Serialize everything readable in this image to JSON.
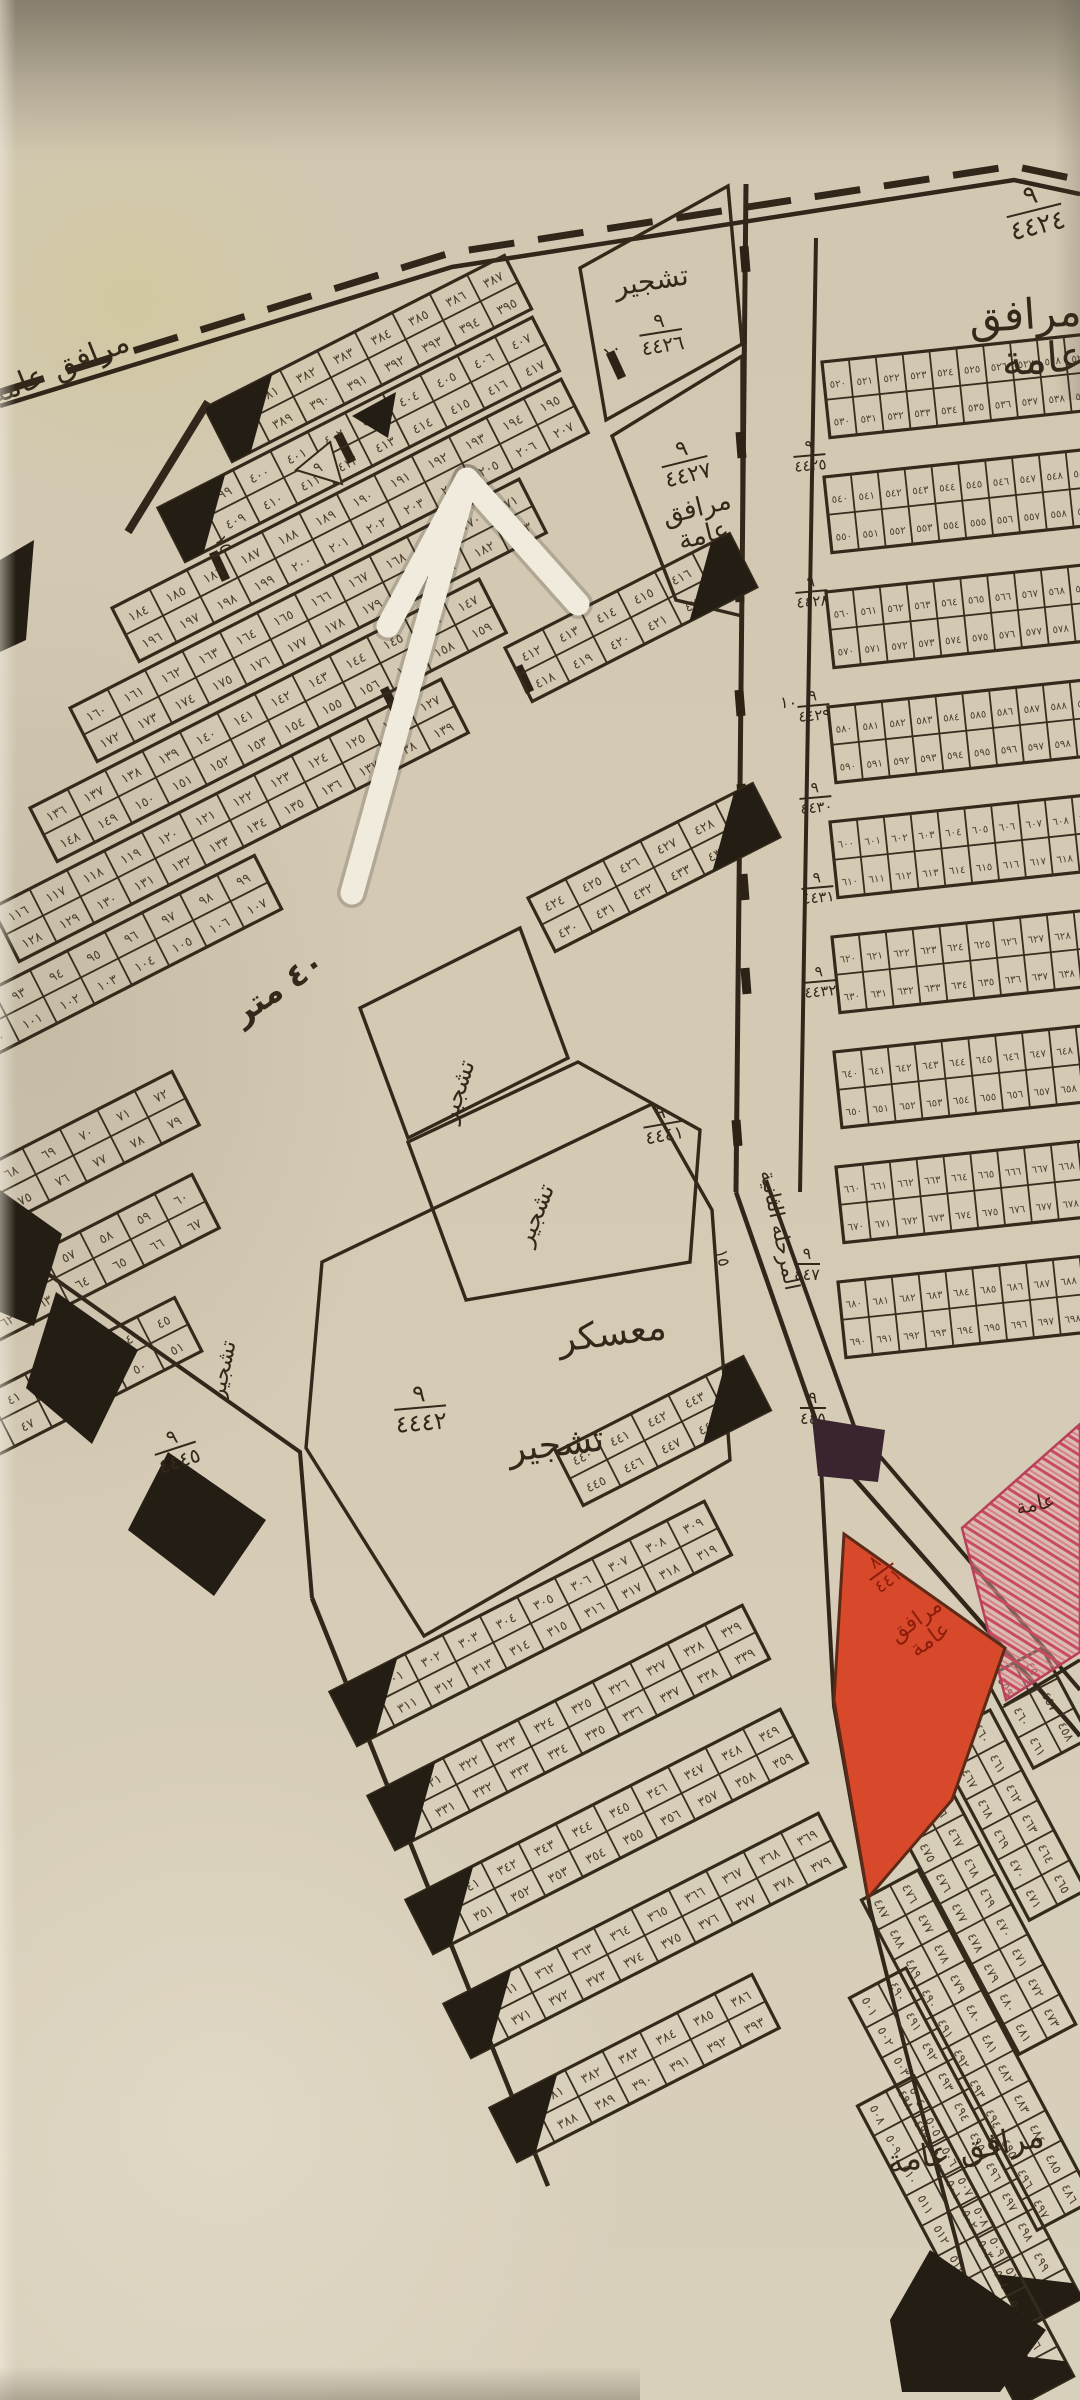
{
  "document": {
    "type": "hand-drawn cadastral subdivision map photograph"
  },
  "colors": {
    "paper": "#d5cbb5",
    "ink": "#33291b",
    "black_fill": "#241d14",
    "red_zone": "#d8492b",
    "pink_hatch": "#c94b63",
    "red_text": "#8c1d0c",
    "arrow": "#f1ebdd"
  },
  "labels": {
    "facilities_top_right": "مرافق عامة",
    "facilities_left": "مرافق عامة",
    "facilities_mid": "مرافق\nعامة",
    "tashjir_top": "تشجير",
    "tashjir_a": "تشجير",
    "tashjir_b": "تشجير",
    "tashjir_left": "تشجير",
    "camp": "معسكر",
    "camp_tashjir": "تشجير",
    "road_forty": "٤٠ متر",
    "road_name_vertical": "المرحلة الثانية",
    "red_facilities": "مرافق\nعامة",
    "pink_amma": "عامة",
    "facilities_bottom": "مرافق عامة",
    "width_15_a": "١٥",
    "width_15_b": "١٥",
    "width_10_a": "١٠",
    "width_10_b": "١٠",
    "small_nine": "٩"
  },
  "fractions": {
    "top_right": {
      "num": "٩",
      "den": "٤٤٢٤"
    },
    "tashjir_top": {
      "num": "٩",
      "den": "٤٤٢٦"
    },
    "mid": {
      "num": "٩",
      "den": "٤٤٢٧"
    },
    "tashjir_b": {
      "num": "٩",
      "den": "٤٤٤١"
    },
    "camp": {
      "num": "٩",
      "den": "٤٤٤٢"
    },
    "left_block": {
      "num": "٩",
      "den": "٤٤٤٥"
    },
    "road_a": {
      "num": "٩",
      "den": "٤٤٧"
    },
    "road_b": {
      "num": "٩",
      "den": "٤٤٥"
    },
    "red": {
      "num": "٨",
      "den": "٤٤١"
    }
  },
  "road_block_ids": [
    {
      "num": "٩",
      "den": "٤٤٢٥",
      "x": 792,
      "y": 440
    },
    {
      "num": "٩",
      "den": "٤٤٢٨",
      "x": 794,
      "y": 576
    },
    {
      "num": "٩",
      "den": "٤٤٢٩",
      "x": 796,
      "y": 690
    },
    {
      "num": "٩",
      "den": "٤٤٣٠",
      "x": 798,
      "y": 782
    },
    {
      "num": "٩",
      "den": "٤٤٣١",
      "x": 800,
      "y": 872
    },
    {
      "num": "٩",
      "den": "٤٤٣٢",
      "x": 802,
      "y": 966
    }
  ],
  "map": {
    "digits": "٠١٢٣٤٥٦٧٨٩",
    "blocks": [
      {
        "x": 205,
        "y": 408,
        "len": 336,
        "a": -27,
        "start": 380,
        "w": "left"
      },
      {
        "x": 158,
        "y": 508,
        "len": 430,
        "a": -27,
        "start": 398,
        "w": "left"
      },
      {
        "x": 112,
        "y": 608,
        "len": 500,
        "a": -27,
        "start": 184
      },
      {
        "x": 70,
        "y": 708,
        "len": 515,
        "a": -27,
        "start": 160
      },
      {
        "x": 30,
        "y": 808,
        "len": 515,
        "a": -27,
        "start": 136
      },
      {
        "x": -8,
        "y": 908,
        "len": 495,
        "a": -27,
        "start": 116
      },
      {
        "x": -45,
        "y": 1008,
        "len": 330,
        "a": -27,
        "start": 92
      },
      {
        "x": -90,
        "y": 1205,
        "len": 300,
        "a": -27,
        "start": 66
      },
      {
        "x": -70,
        "y": 1308,
        "len": 285,
        "a": -27,
        "start": 54
      },
      {
        "x": -50,
        "y": 1412,
        "len": 260,
        "a": -27,
        "start": 40
      },
      {
        "x": 505,
        "y": 648,
        "len": 240,
        "a": -27,
        "start": 412,
        "w": "right"
      },
      {
        "x": 528,
        "y": 898,
        "len": 245,
        "a": -27,
        "start": 424,
        "w": "right"
      },
      {
        "x": 556,
        "y": 1452,
        "len": 225,
        "a": -27,
        "start": 440,
        "w": "right"
      },
      {
        "x": 330,
        "y": 1692,
        "len": 420,
        "a": -27,
        "start": 300,
        "w": "left"
      },
      {
        "x": 368,
        "y": 1796,
        "len": 420,
        "a": -27,
        "start": 320,
        "w": "left"
      },
      {
        "x": 406,
        "y": 1900,
        "len": 420,
        "a": -27,
        "start": 340,
        "w": "left"
      },
      {
        "x": 444,
        "y": 2004,
        "len": 400,
        "a": -27,
        "start": 360,
        "w": "left"
      },
      {
        "x": 490,
        "y": 2108,
        "len": 300,
        "a": -27,
        "start": 380,
        "w": "left"
      },
      {
        "x": 822,
        "y": 362,
        "len": 268,
        "a": -6,
        "cw": 27,
        "ch": 38,
        "start": 520
      },
      {
        "x": 824,
        "y": 477,
        "len": 268,
        "a": -6,
        "cw": 27,
        "ch": 38,
        "start": 540
      },
      {
        "x": 826,
        "y": 592,
        "len": 268,
        "a": -6,
        "cw": 27,
        "ch": 38,
        "start": 560
      },
      {
        "x": 828,
        "y": 707,
        "len": 268,
        "a": -6,
        "cw": 27,
        "ch": 38,
        "start": 580
      },
      {
        "x": 830,
        "y": 822,
        "len": 268,
        "a": -6,
        "cw": 27,
        "ch": 38,
        "start": 600
      },
      {
        "x": 832,
        "y": 937,
        "len": 268,
        "a": -6,
        "cw": 27,
        "ch": 38,
        "start": 620
      },
      {
        "x": 834,
        "y": 1052,
        "len": 268,
        "a": -6,
        "cw": 27,
        "ch": 38,
        "start": 640
      },
      {
        "x": 836,
        "y": 1167,
        "len": 268,
        "a": -6,
        "cw": 27,
        "ch": 38,
        "start": 660
      },
      {
        "x": 838,
        "y": 1282,
        "len": 268,
        "a": -6,
        "cw": 27,
        "ch": 38,
        "start": 680
      },
      {
        "x": 1042,
        "y": 1648,
        "len": 110,
        "a": 62,
        "cw": 34,
        "ch": 32,
        "start": 456
      },
      {
        "x": 990,
        "y": 1710,
        "len": 200,
        "a": 62,
        "cw": 34,
        "ch": 32,
        "start": 460
      },
      {
        "x": 948,
        "y": 1784,
        "len": 280,
        "a": 62,
        "cw": 34,
        "ch": 32,
        "start": 466
      },
      {
        "x": 918,
        "y": 1870,
        "len": 360,
        "a": 62,
        "cw": 34,
        "ch": 32,
        "start": 476
      },
      {
        "x": 906,
        "y": 1968,
        "len": 380,
        "a": 62,
        "cw": 34,
        "ch": 32,
        "start": 490,
        "w": "right"
      },
      {
        "x": 914,
        "y": 2076,
        "len": 330,
        "a": 62,
        "cw": 34,
        "ch": 32,
        "start": 498,
        "w": "right"
      }
    ]
  }
}
